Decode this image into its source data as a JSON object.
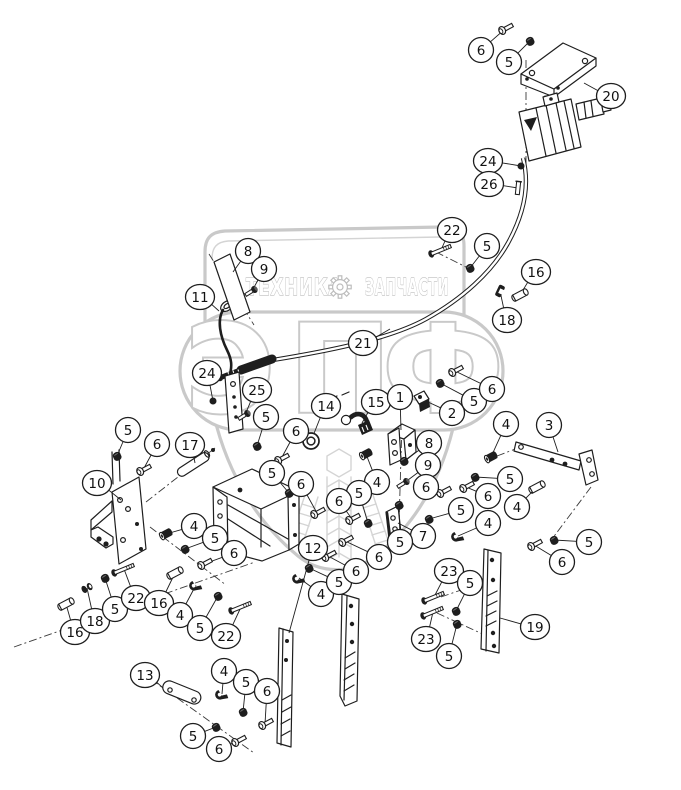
{
  "page": {
    "type": "exploded-parts-diagram"
  },
  "colors": {
    "line": "#1e1e1e",
    "watermark_outline": "#c9c9c9",
    "watermark_text_outline": "#bdbdbd",
    "background": "#ffffff"
  },
  "watermark": {
    "technika": "ТЕХНИКА",
    "zapchasti": "ЗАПЧАСТИ",
    "gear_icon": "gear",
    "eppf_letters": [
      "Э",
      "П",
      "Ф"
    ]
  },
  "callouts": [
    {
      "n": "6",
      "x": 481,
      "y": 50,
      "tx": 505,
      "ty": 29,
      "g": "bolt"
    },
    {
      "n": "5",
      "x": 509,
      "y": 62,
      "tx": 530,
      "ty": 41,
      "g": "nut"
    },
    {
      "n": "20",
      "x": 611,
      "y": 96,
      "tx": 584,
      "ty": 83,
      "g": null
    },
    {
      "n": "24",
      "x": 488,
      "y": 161,
      "tx": 521,
      "ty": 166,
      "g": "grommet"
    },
    {
      "n": "26",
      "x": 489,
      "y": 184,
      "tx": 518,
      "ty": 188,
      "g": "clip"
    },
    {
      "n": "22",
      "x": 452,
      "y": 230,
      "tx": 441,
      "ty": 250,
      "g": "longbolt"
    },
    {
      "n": "5",
      "x": 487,
      "y": 246,
      "tx": 470,
      "ty": 268,
      "g": "nut"
    },
    {
      "n": "16",
      "x": 536,
      "y": 272,
      "tx": 520,
      "ty": 295,
      "g": "bushing"
    },
    {
      "n": "18",
      "x": 507,
      "y": 320,
      "tx": 500,
      "ty": 291,
      "g": "cclamp"
    },
    {
      "n": "8",
      "x": 248,
      "y": 251,
      "tx": 233,
      "ty": 272,
      "g": null
    },
    {
      "n": "9",
      "x": 264,
      "y": 269,
      "tx": 252,
      "ty": 291,
      "g": "screw"
    },
    {
      "n": "11",
      "x": 200,
      "y": 297,
      "tx": 219,
      "ty": 311,
      "g": null
    },
    {
      "n": "21",
      "x": 363,
      "y": 343,
      "tx": 390,
      "ty": 329,
      "g": null
    },
    {
      "n": "24",
      "x": 207,
      "y": 373,
      "tx": 213,
      "ty": 401,
      "g": "grommet"
    },
    {
      "n": "25",
      "x": 257,
      "y": 390,
      "tx": 245,
      "ty": 415,
      "g": "screw"
    },
    {
      "n": "5",
      "x": 266,
      "y": 417,
      "tx": 257,
      "ty": 446,
      "g": "nut"
    },
    {
      "n": "6",
      "x": 296,
      "y": 431,
      "tx": 281,
      "ty": 459,
      "g": "bolt"
    },
    {
      "n": "14",
      "x": 326,
      "y": 406,
      "tx": 311,
      "ty": 441,
      "g": "washer"
    },
    {
      "n": "15",
      "x": 376,
      "y": 402,
      "tx": 362,
      "ty": 423,
      "g": null
    },
    {
      "n": "1",
      "x": 400,
      "y": 397,
      "tx": 401,
      "ty": 430,
      "g": null
    },
    {
      "n": "2",
      "x": 452,
      "y": 413,
      "tx": 428,
      "ty": 402,
      "g": null
    },
    {
      "n": "5",
      "x": 474,
      "y": 401,
      "tx": 440,
      "ty": 383,
      "g": "nut"
    },
    {
      "n": "6",
      "x": 492,
      "y": 389,
      "tx": 455,
      "ty": 371,
      "g": "bolt"
    },
    {
      "n": "8",
      "x": 429,
      "y": 443,
      "tx": 404,
      "ty": 461,
      "g": "nut"
    },
    {
      "n": "9",
      "x": 428,
      "y": 465,
      "tx": 404,
      "ty": 483,
      "g": "screw"
    },
    {
      "n": "6",
      "x": 426,
      "y": 487,
      "tx": 443,
      "ty": 492,
      "g": "bolt"
    },
    {
      "n": "4",
      "x": 377,
      "y": 482,
      "tx": 366,
      "ty": 454,
      "g": "bushing2"
    },
    {
      "n": "5",
      "x": 359,
      "y": 493,
      "tx": 368,
      "ty": 523,
      "g": "nut"
    },
    {
      "n": "6",
      "x": 339,
      "y": 501,
      "tx": 352,
      "ty": 519,
      "g": "bolt"
    },
    {
      "n": "3",
      "x": 549,
      "y": 425,
      "tx": 558,
      "ty": 452,
      "g": null
    },
    {
      "n": "4",
      "x": 506,
      "y": 424,
      "tx": 491,
      "ty": 457,
      "g": "bushing2"
    },
    {
      "n": "5",
      "x": 510,
      "y": 479,
      "tx": 475,
      "ty": 477,
      "g": "nut"
    },
    {
      "n": "6",
      "x": 488,
      "y": 496,
      "tx": 466,
      "ty": 487,
      "g": "bolt"
    },
    {
      "n": "5",
      "x": 461,
      "y": 510,
      "tx": 429,
      "ty": 519,
      "g": "nut"
    },
    {
      "n": "4",
      "x": 488,
      "y": 523,
      "tx": 458,
      "ty": 536,
      "g": "clamp"
    },
    {
      "n": "7",
      "x": 423,
      "y": 536,
      "tx": 398,
      "ty": 523,
      "g": null
    },
    {
      "n": "5",
      "x": 400,
      "y": 542,
      "tx": 399,
      "ty": 505,
      "g": "nut"
    },
    {
      "n": "4",
      "x": 517,
      "y": 507,
      "tx": 537,
      "ty": 487,
      "g": "bushing"
    },
    {
      "n": "5",
      "x": 589,
      "y": 542,
      "tx": 554,
      "ty": 540,
      "g": "nut"
    },
    {
      "n": "6",
      "x": 562,
      "y": 562,
      "tx": 534,
      "ty": 545,
      "g": "bolt"
    },
    {
      "n": "5",
      "x": 128,
      "y": 430,
      "tx": 117,
      "ty": 456,
      "g": "nut"
    },
    {
      "n": "6",
      "x": 157,
      "y": 444,
      "tx": 143,
      "ty": 470,
      "g": "bolt"
    },
    {
      "n": "17",
      "x": 190,
      "y": 445,
      "tx": 195,
      "ty": 463,
      "g": null
    },
    {
      "n": "10",
      "x": 97,
      "y": 483,
      "tx": 121,
      "ty": 500,
      "g": null
    },
    {
      "n": "4",
      "x": 194,
      "y": 526,
      "tx": 166,
      "ty": 534,
      "g": "bushing2"
    },
    {
      "n": "5",
      "x": 215,
      "y": 538,
      "tx": 185,
      "ty": 549,
      "g": "nut"
    },
    {
      "n": "6",
      "x": 234,
      "y": 553,
      "tx": 204,
      "ty": 564,
      "g": "bolt"
    },
    {
      "n": "5",
      "x": 272,
      "y": 473,
      "tx": 289,
      "ty": 493,
      "g": "nut"
    },
    {
      "n": "6",
      "x": 301,
      "y": 484,
      "tx": 317,
      "ty": 513,
      "g": "bolt"
    },
    {
      "n": "16",
      "x": 75,
      "y": 632,
      "tx": 66,
      "ty": 604,
      "g": "bushing"
    },
    {
      "n": "18",
      "x": 95,
      "y": 621,
      "tx": 87,
      "ty": 588,
      "g": "spacer"
    },
    {
      "n": "5",
      "x": 115,
      "y": 609,
      "tx": 105,
      "ty": 578,
      "g": "nut"
    },
    {
      "n": "22",
      "x": 136,
      "y": 598,
      "tx": 124,
      "ty": 569,
      "g": "longbolt"
    },
    {
      "n": "16",
      "x": 159,
      "y": 603,
      "tx": 175,
      "ty": 573,
      "g": "bushing"
    },
    {
      "n": "4",
      "x": 180,
      "y": 615,
      "tx": 196,
      "ty": 585,
      "g": "clamp"
    },
    {
      "n": "5",
      "x": 200,
      "y": 628,
      "tx": 218,
      "ty": 596,
      "g": "nut"
    },
    {
      "n": "22",
      "x": 226,
      "y": 636,
      "tx": 241,
      "ty": 607,
      "g": "longbolt"
    },
    {
      "n": "12",
      "x": 313,
      "y": 548,
      "tx": 289,
      "ty": 633,
      "g": null
    },
    {
      "n": "4",
      "x": 321,
      "y": 594,
      "tx": 299,
      "ty": 578,
      "g": "clamp"
    },
    {
      "n": "5",
      "x": 339,
      "y": 582,
      "tx": 309,
      "ty": 568,
      "g": "nut"
    },
    {
      "n": "6",
      "x": 356,
      "y": 571,
      "tx": 328,
      "ty": 556,
      "g": "bolt"
    },
    {
      "n": "6",
      "x": 379,
      "y": 557,
      "tx": 345,
      "ty": 541,
      "g": "bolt"
    },
    {
      "n": "23",
      "x": 449,
      "y": 571,
      "tx": 434,
      "ty": 597,
      "g": "longbolt"
    },
    {
      "n": "5",
      "x": 470,
      "y": 583,
      "tx": 456,
      "ty": 611,
      "g": "nut"
    },
    {
      "n": "23",
      "x": 426,
      "y": 639,
      "tx": 433,
      "ty": 612,
      "g": "longbolt"
    },
    {
      "n": "5",
      "x": 449,
      "y": 656,
      "tx": 457,
      "ty": 624,
      "g": "nut"
    },
    {
      "n": "19",
      "x": 535,
      "y": 627,
      "tx": 500,
      "ty": 618,
      "g": null
    },
    {
      "n": "13",
      "x": 145,
      "y": 675,
      "tx": 163,
      "ty": 688,
      "g": null
    },
    {
      "n": "4",
      "x": 224,
      "y": 671,
      "tx": 222,
      "ty": 694,
      "g": "clamp"
    },
    {
      "n": "5",
      "x": 246,
      "y": 682,
      "tx": 243,
      "ty": 712,
      "g": "nut"
    },
    {
      "n": "6",
      "x": 267,
      "y": 691,
      "tx": 265,
      "ty": 724,
      "g": "bolt"
    },
    {
      "n": "5",
      "x": 193,
      "y": 736,
      "tx": 216,
      "ty": 727,
      "g": "nut"
    },
    {
      "n": "6",
      "x": 219,
      "y": 749,
      "tx": 238,
      "ty": 741,
      "g": "bolt"
    }
  ]
}
